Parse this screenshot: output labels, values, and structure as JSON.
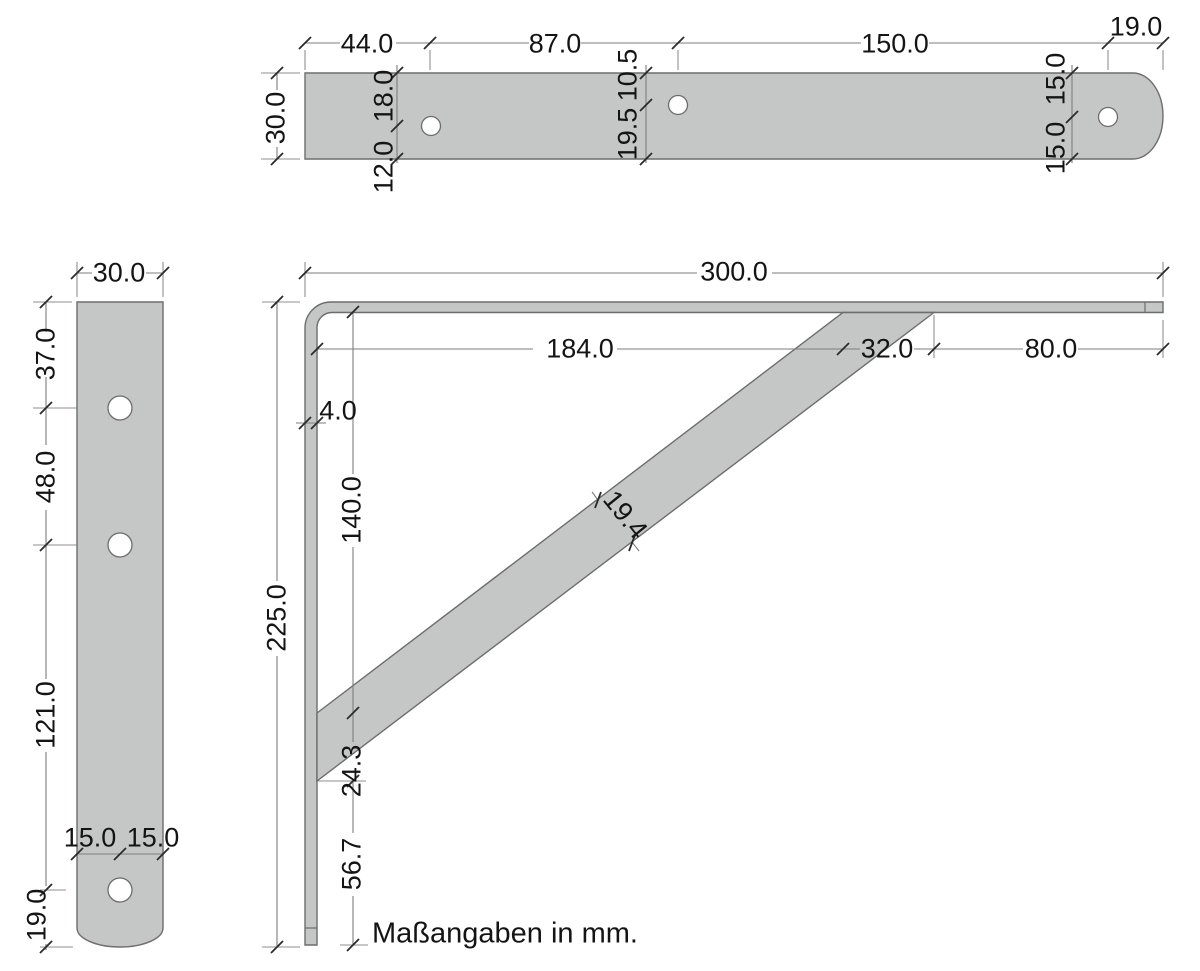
{
  "units_note": "Maßangaben in mm.",
  "top_view": {
    "length_segments": [
      "44.0",
      "87.0",
      "150.0",
      "19.0"
    ],
    "width": "30.0",
    "hole1_from_top": "18.0",
    "hole1_from_bottom": "12.0",
    "hole2_from_top": "10.5",
    "hole2_from_bottom": "19.5",
    "hole3_from_top": "15.0",
    "hole3_from_bottom": "15.0"
  },
  "side_view": {
    "width": "30.0",
    "height_segments": [
      "37.0",
      "48.0",
      "121.0",
      "19.0"
    ],
    "hole_offset_left": "15.0",
    "hole_offset_right": "15.0"
  },
  "front_view": {
    "total_width": "300.0",
    "total_height": "225.0",
    "top_segments": [
      "184.0",
      "32.0",
      "80.0"
    ],
    "material_thickness": "4.0",
    "left_segments": [
      "140.0",
      "24.3",
      "56.7"
    ],
    "brace_width": "19.4"
  },
  "colors": {
    "part_fill": "#c5c6c6",
    "part_stroke": "#6d6d6d",
    "dimension_line": "#7e7e7e",
    "extension_line": "#8f8f8f",
    "tick": "#2b2b2b",
    "text": "#141414",
    "hole_fill": "#ffffff"
  }
}
